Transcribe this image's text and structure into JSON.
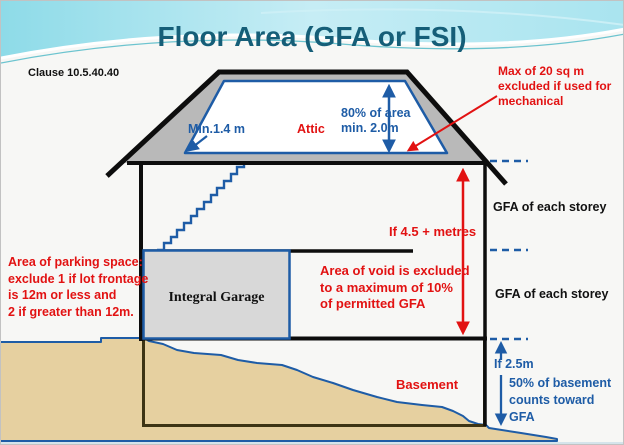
{
  "slide": {
    "title": "Floor Area (GFA or FSI)",
    "clause": "Clause 10.5.40.40"
  },
  "roof": {
    "attic_label": "Attic",
    "min_height_label": "Min.1.4 m",
    "area_rule_label": "80% of area\nmin. 2.0m",
    "mechanical_note": "Max of 20 sq m\nexcluded if used for\nmechanical"
  },
  "storeys": {
    "gfa_upper_label": "GFA of each storey",
    "gfa_lower_label": "GFA of each storey",
    "void_height_label": "If 4.5 + metres",
    "void_rule": "Area of void is excluded\nto a maximum of 10%\nof permitted GFA"
  },
  "ground_floor": {
    "garage_label": "Integral Garage",
    "parking_rule": "Area of parking space:\nexclude 1 if lot frontage\nis 12m or less and\n2 if greater than 12m."
  },
  "basement": {
    "label": "Basement",
    "depth_label": "If 2.5m",
    "count_rule": "50% of basement\ncounts toward\nGFA"
  },
  "icons": {
    "double_arrow": "↕",
    "arrow_up": "↑",
    "arrow_down": "↓",
    "arrow_diagonal": "↙"
  },
  "colors": {
    "title_teal": "#155e78",
    "diagram_blue": "#1e5ca6",
    "note_red": "#e21212",
    "roof_gray": "#b9b9b9",
    "garage_gray": "#d8d8d8",
    "ground_tan": "#e6d0a0",
    "basement_outline": "#3d3414",
    "wave_cyan": "#9fdfeb"
  }
}
